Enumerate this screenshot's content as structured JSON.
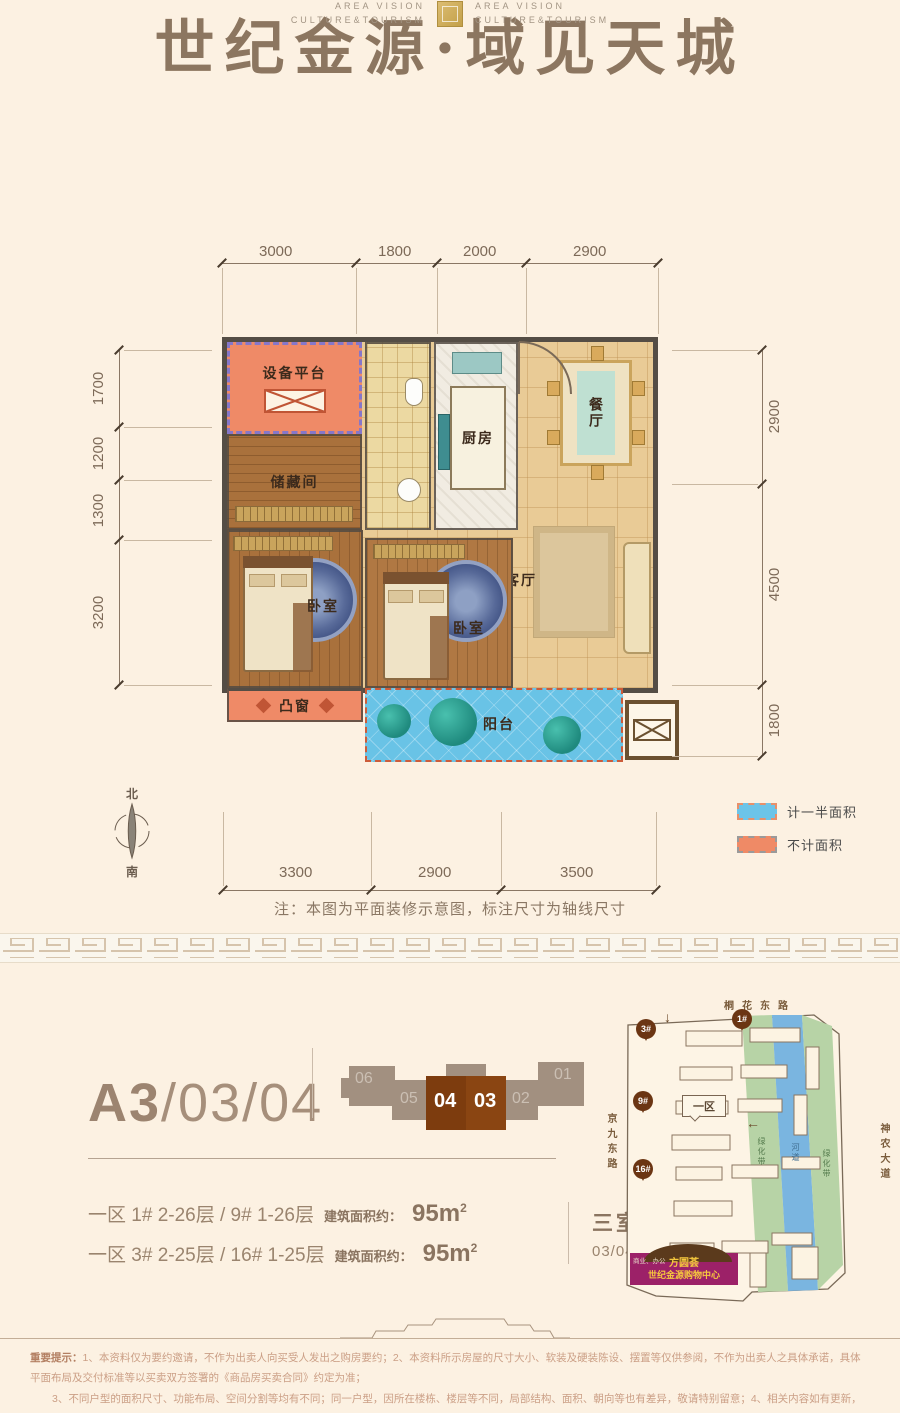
{
  "header": {
    "title": "世纪金源·域见天城",
    "brand_line1": "AREA VISION",
    "brand_line2": "CULTURE&TOURISM"
  },
  "plan": {
    "rooms": {
      "equipment": "设备平台",
      "storage": "储藏间",
      "kitchen": "厨房",
      "dining": "餐厅",
      "living": "客厅",
      "bedroom1": "卧室",
      "bedroom2": "卧室",
      "bay_window": "凸窗",
      "balcony": "阳台"
    },
    "dims": {
      "top": [
        "3000",
        "1800",
        "2000",
        "2900"
      ],
      "left": [
        "1700",
        "1200",
        "1300",
        "3200"
      ],
      "right": [
        "2900",
        "4500",
        "1800"
      ],
      "bottom": [
        "3300",
        "2900",
        "3500"
      ]
    },
    "compass": {
      "north": "北",
      "south": "南"
    },
    "legend": {
      "half_area": "计一半面积",
      "half_color": "#6cc4e8",
      "excluded_area": "不计面积",
      "excluded_color": "#ef8a66"
    },
    "note": "注：本图为平面装修示意图，标注尺寸为轴线尺寸"
  },
  "unit": {
    "code_main": "A3",
    "code_suffix": "/03/04",
    "stack_units": [
      "06",
      "05",
      "04",
      "03",
      "02",
      "01"
    ],
    "highlighted_units": [
      "04",
      "03"
    ],
    "rows": [
      {
        "buildings": "一区 1# 2-26层 / 9# 1-26层",
        "area_label": "建筑面积约：",
        "area_value": "95m",
        "area_sup": "2"
      },
      {
        "buildings": "一区 3# 2-25层 / 16# 1-25层",
        "area_label": "建筑面积约：",
        "area_value": "95m",
        "area_sup": "2"
      }
    ],
    "layout_type": "三室两厅一卫",
    "plan_caption": "03/04平面示意图"
  },
  "map": {
    "road_top": "桐花东路",
    "road_left": "京九东路",
    "road_right": "神农大道",
    "greenbelt1": "绿化带",
    "river": "河道",
    "greenbelt2": "绿化带",
    "zone_label": "一区",
    "markers": [
      "3#",
      "1#",
      "9#",
      "16#"
    ],
    "arrow_down": "↓",
    "arrow_left": "←",
    "mall_line1": "方圆荟",
    "mall_line2": "世纪金源购物中心",
    "mall_side_note": "商业、办公",
    "mall_color": "#9c2168"
  },
  "footer": {
    "bold_prefix": "重要提示：",
    "line1": "1、本资料仅为要约邀请，不作为出卖人向买受人发出之购房要约；2、本资料所示房屋的尺寸大小、软装及硬装陈设、摆置等仅供参阅，不作为出卖人之具体承诺，具体平面布局及交付标准等以买卖双方签署的《商品房买卖合同》约定为准；",
    "line2": "3、不同户型的面积尺寸、功能布局、空间分割等均有不同；同一户型，因所在楼栋、楼层等不同，局部结构、面积、朝向等也有差异，敬请特别留意；4、相关内容如有更新，请以最近资料为准，敬请留意。本资料绘制日期：2019年12月21日。"
  }
}
